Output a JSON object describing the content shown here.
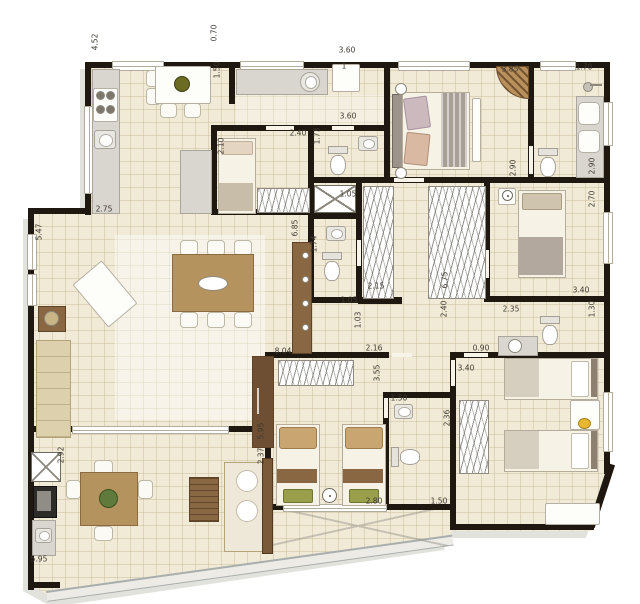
{
  "plan": {
    "type": "apartment-floor-plan",
    "description": "4-bedroom apartment floor plan with gourmet balcony, top-view furnished",
    "dimension_unit": "m"
  },
  "colors": {
    "background": "#ffffff",
    "floor": "#f1ead7",
    "floor_grid": "#c7ba96",
    "wall": "#1f1811",
    "wood": "#b5935f",
    "wood_dark": "#8a6743",
    "counter": "#d9d6cf",
    "fabric": "#ddd0ac",
    "blanket": "#a89f96",
    "kids_pillow": "#c9a571",
    "foot_pillow": "#9aa04a",
    "toy_duck": "#e8b832",
    "label_text": "#3f3a31",
    "railing": "#a9aeac"
  },
  "rooms": [
    {
      "name": "kitchen"
    },
    {
      "name": "laundry-service-area"
    },
    {
      "name": "maid-bedroom"
    },
    {
      "name": "service-wc"
    },
    {
      "name": "duct-shaft"
    },
    {
      "name": "guest-bathroom"
    },
    {
      "name": "living-dining-room"
    },
    {
      "name": "walk-in-closet"
    },
    {
      "name": "hall-corridor"
    },
    {
      "name": "master-bedroom"
    },
    {
      "name": "master-bathroom"
    },
    {
      "name": "bedroom-2"
    },
    {
      "name": "bathroom-3"
    },
    {
      "name": "kids-bedroom-1"
    },
    {
      "name": "kids-bathroom"
    },
    {
      "name": "kids-bedroom-2"
    },
    {
      "name": "gourmet-balcony"
    }
  ],
  "dimension_labels": [
    {
      "text": "4.52",
      "x": 95,
      "y": 42,
      "v": true
    },
    {
      "text": "0.70",
      "x": 214,
      "y": 33,
      "v": true
    },
    {
      "text": "1.50",
      "x": 217,
      "y": 70,
      "v": true
    },
    {
      "text": "3.60",
      "x": 347,
      "y": 50,
      "v": false
    },
    {
      "text": "1",
      "x": 344,
      "y": 66,
      "v": false
    },
    {
      "text": "3.60",
      "x": 348,
      "y": 116,
      "v": false
    },
    {
      "text": "2.40",
      "x": 298,
      "y": 133,
      "v": false
    },
    {
      "text": "1.73",
      "x": 317,
      "y": 136,
      "v": true
    },
    {
      "text": "2.10",
      "x": 221,
      "y": 146,
      "v": true
    },
    {
      "text": "2.75",
      "x": 104,
      "y": 209,
      "v": false
    },
    {
      "text": "5.47",
      "x": 39,
      "y": 232,
      "v": true
    },
    {
      "text": "6.85",
      "x": 295,
      "y": 228,
      "v": true
    },
    {
      "text": "1.05",
      "x": 348,
      "y": 194,
      "v": false
    },
    {
      "text": "1.74",
      "x": 314,
      "y": 244,
      "v": true
    },
    {
      "text": "1.05",
      "x": 349,
      "y": 300,
      "v": false
    },
    {
      "text": "1.03",
      "x": 358,
      "y": 320,
      "v": true
    },
    {
      "text": "2.15",
      "x": 376,
      "y": 286,
      "v": false
    },
    {
      "text": "6.75",
      "x": 445,
      "y": 280,
      "v": true
    },
    {
      "text": "2.40",
      "x": 444,
      "y": 309,
      "v": true
    },
    {
      "text": "2.16",
      "x": 374,
      "y": 348,
      "v": false
    },
    {
      "text": "0.90",
      "x": 481,
      "y": 348,
      "v": false
    },
    {
      "text": "3.85",
      "x": 510,
      "y": 69,
      "v": false
    },
    {
      "text": "1.70",
      "x": 584,
      "y": 67,
      "v": false
    },
    {
      "text": "2.90",
      "x": 513,
      "y": 168,
      "v": true
    },
    {
      "text": "2.90",
      "x": 592,
      "y": 166,
      "v": true
    },
    {
      "text": "2.70",
      "x": 592,
      "y": 199,
      "v": true
    },
    {
      "text": "3.40",
      "x": 581,
      "y": 290,
      "v": false
    },
    {
      "text": "2.35",
      "x": 511,
      "y": 309,
      "v": false
    },
    {
      "text": "1.30",
      "x": 592,
      "y": 309,
      "v": true
    },
    {
      "text": "3.40",
      "x": 466,
      "y": 368,
      "v": false
    },
    {
      "text": "3.55",
      "x": 377,
      "y": 373,
      "v": true
    },
    {
      "text": "8.04",
      "x": 283,
      "y": 351,
      "v": false
    },
    {
      "text": "5.95",
      "x": 261,
      "y": 431,
      "v": true
    },
    {
      "text": "2.37",
      "x": 261,
      "y": 456,
      "v": true
    },
    {
      "text": "2.92",
      "x": 61,
      "y": 455,
      "v": true
    },
    {
      "text": "5.95",
      "x": 39,
      "y": 559,
      "v": false
    },
    {
      "text": "1.50",
      "x": 399,
      "y": 398,
      "v": false
    },
    {
      "text": "2.36",
      "x": 447,
      "y": 418,
      "v": true
    },
    {
      "text": "2.80",
      "x": 374,
      "y": 501,
      "v": false
    },
    {
      "text": "1.50",
      "x": 439,
      "y": 501,
      "v": false
    }
  ]
}
